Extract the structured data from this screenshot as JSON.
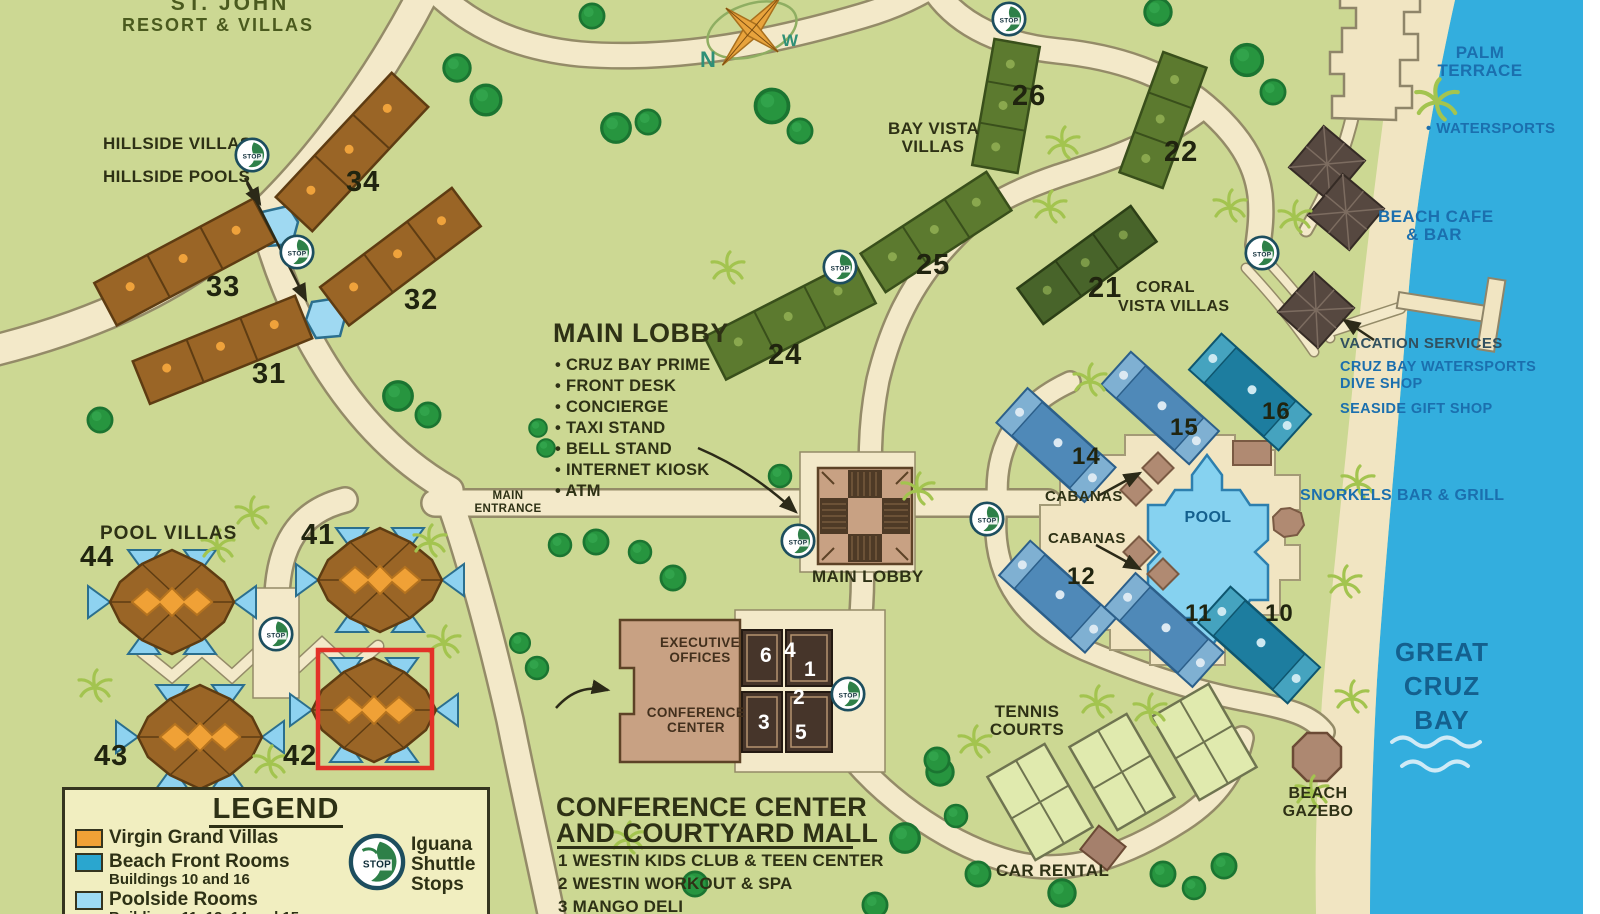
{
  "colors": {
    "land": "#ccd893",
    "water": "#33aede",
    "sand": "#f1e5c2",
    "road": "#f3e9c9",
    "virgin_grand_villas": "#f0a136",
    "beach_front_rooms": "#2aa6cf",
    "poolside_rooms": "#9ddcf5",
    "hillside_villa_brown": "#9a6526",
    "bay_vista_olive": "#5c7a2f",
    "highlight_red": "#e33128",
    "label_dark": "#2e3115",
    "label_blue": "#1b6fae"
  },
  "title": {
    "line1": "ST. JOHN",
    "line2": "RESORT & VILLAS"
  },
  "compass": {
    "north": "N",
    "west": "W"
  },
  "hillside": {
    "villas_label": "HILLSIDE VILLAS",
    "pools_label": "HILLSIDE POOLS"
  },
  "bay_vista": {
    "line1": "BAY VISTA",
    "line2": "VILLAS"
  },
  "coral_vista": {
    "line1": "CORAL",
    "line2": "VISTA VILLAS"
  },
  "numbers": {
    "h31": "31",
    "h32": "32",
    "h33": "33",
    "h34": "34",
    "b21": "21",
    "b22": "22",
    "b24": "24",
    "b25": "25",
    "b26": "26",
    "p10": "10",
    "p11": "11",
    "p12": "12",
    "p14": "14",
    "p15": "15",
    "p16": "16",
    "v41": "41",
    "v42": "42",
    "v43": "43",
    "v44": "44"
  },
  "main_lobby_info": {
    "title": "MAIN LOBBY",
    "items": [
      "CRUZ BAY PRIME",
      "FRONT DESK",
      "CONCIERGE",
      "TAXI STAND",
      "BELL STAND",
      "INTERNET KIOSK",
      "ATM"
    ]
  },
  "labels": {
    "main_entrance_line1": "MAIN",
    "main_entrance_line2": "ENTRANCE",
    "main_lobby": "MAIN LOBBY",
    "pool": "POOL",
    "cabanas_upper": "CABANAS",
    "cabanas_lower": "CABANAS",
    "snorkels": "SNORKELS BAR & GRILL",
    "palm_terrace_line1": "PALM",
    "palm_terrace_line2": "TERRACE",
    "watersports": "• WATERSPORTS",
    "beach_cafe_line1": "BEACH CAFE",
    "beach_cafe_line2": "& BAR",
    "vacation_services": "VACATION SERVICES",
    "dive_shop_line1": "CRUZ BAY WATERSPORTS",
    "dive_shop_line2": "DIVE SHOP",
    "gift_shop": "SEASIDE GIFT SHOP",
    "great_cruz_line1": "GREAT",
    "great_cruz_line2": "CRUZ",
    "great_cruz_line3": "BAY",
    "tennis_line1": "TENNIS",
    "tennis_line2": "COURTS",
    "car_rental": "CAR RENTAL",
    "beach_gazebo_line1": "BEACH",
    "beach_gazebo_line2": "GAZEBO",
    "pool_villas": "POOL VILLAS"
  },
  "conference_building": {
    "exec_line1": "EXECUTIVE",
    "exec_line2": "OFFICES",
    "conf_line1": "CONFERENCE",
    "conf_line2": "CENTER",
    "rooms": [
      "6",
      "4",
      "1",
      "2",
      "3",
      "5"
    ]
  },
  "courtyard": {
    "heading_line1": "CONFERENCE CENTER",
    "heading_line2": "AND COURTYARD MALL",
    "items": [
      "1 WESTIN KIDS CLUB & TEEN CENTER",
      "2 WESTIN WORKOUT & SPA",
      "3 MANGO DELI"
    ]
  },
  "legend": {
    "title": "LEGEND",
    "items": [
      {
        "label": "Virgin Grand Villas",
        "sublabel": "",
        "color": "#f0a136"
      },
      {
        "label": "Beach Front Rooms",
        "sublabel": "Buildings 10 and 16",
        "color": "#2aa6cf"
      },
      {
        "label": "Poolside Rooms",
        "sublabel": "Buildings 11, 12, 14 and 15",
        "color": "#9ddcf5"
      }
    ],
    "shuttle_line1": "Iguana",
    "shuttle_line2": "Shuttle",
    "shuttle_line3": "Stops"
  },
  "shuttle": {
    "stop_text": "STOP"
  }
}
